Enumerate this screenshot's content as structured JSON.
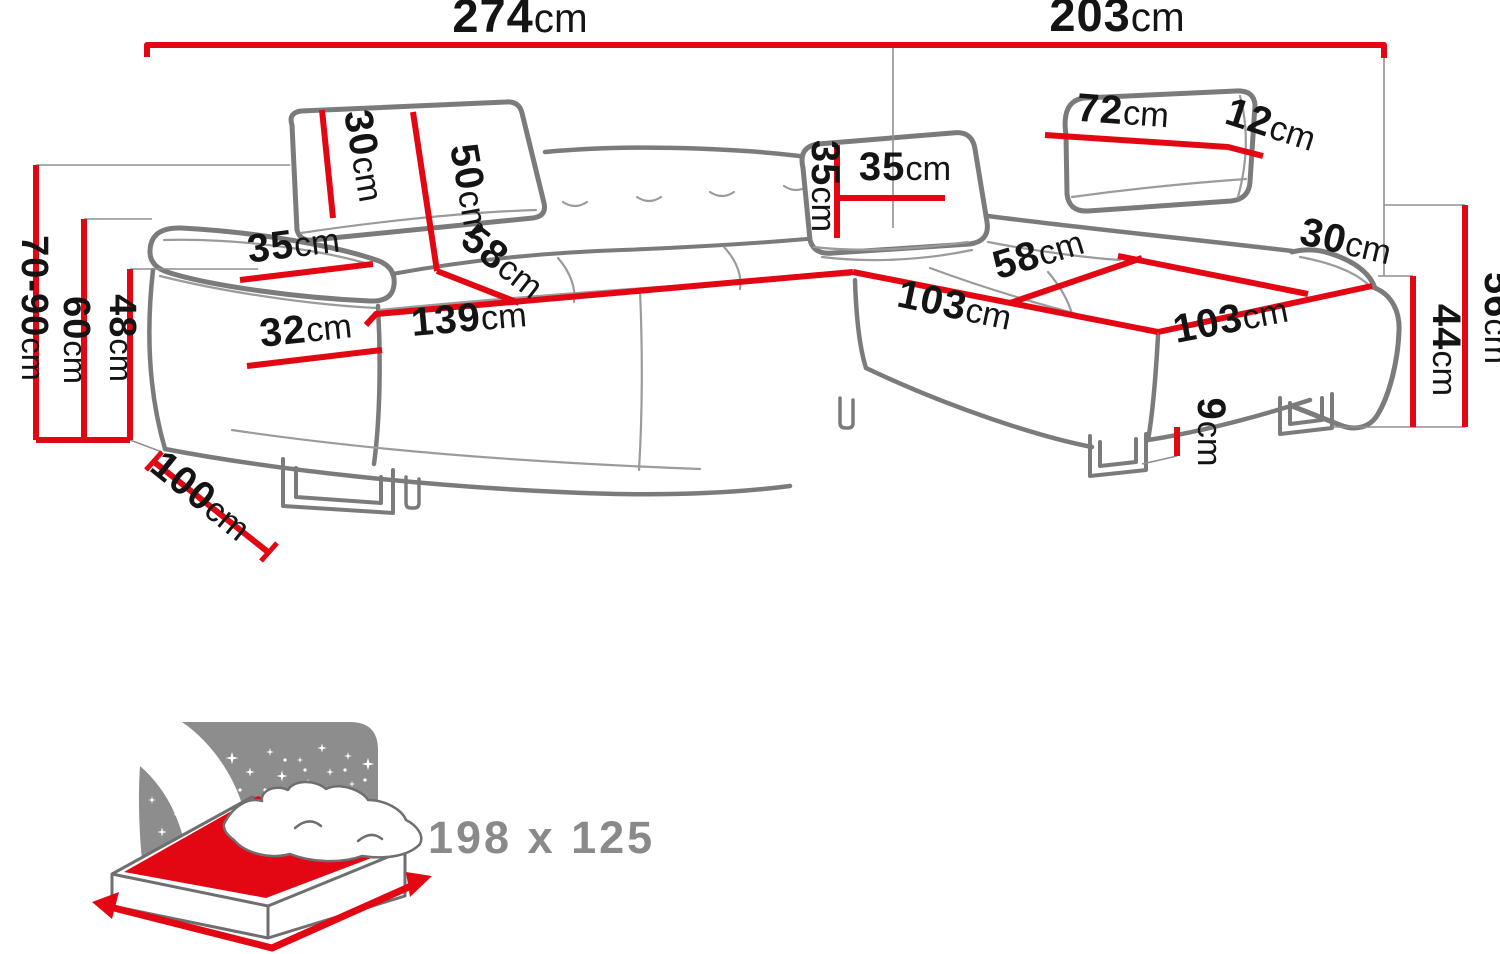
{
  "dims": {
    "width_left": {
      "num": "274",
      "unit": "cm"
    },
    "width_right": {
      "num": "203",
      "unit": "cm"
    },
    "height_total": {
      "num": "70-90",
      "unit": "cm"
    },
    "height_armrest": {
      "num": "60",
      "unit": "cm"
    },
    "height_seat": {
      "num": "48",
      "unit": "cm"
    },
    "headrest_left_h": {
      "num": "30",
      "unit": "cm"
    },
    "backrest_h": {
      "num": "50",
      "unit": "cm"
    },
    "seat_depth_left": {
      "num": "58",
      "unit": "cm"
    },
    "armrest_top_w": {
      "num": "35",
      "unit": "cm"
    },
    "armrest_front_w": {
      "num": "32",
      "unit": "cm"
    },
    "seat_width_left": {
      "num": "139",
      "unit": "cm"
    },
    "depth_left": {
      "num": "100",
      "unit": "cm"
    },
    "pillow_h": {
      "num": "35",
      "unit": "cm"
    },
    "pillow_w": {
      "num": "35",
      "unit": "cm"
    },
    "headrest_right_w": {
      "num": "72",
      "unit": "cm"
    },
    "headrest_gap": {
      "num": "12",
      "unit": "cm"
    },
    "armrest_right_w": {
      "num": "30",
      "unit": "cm"
    },
    "seat_depth_right": {
      "num": "58",
      "unit": "cm"
    },
    "chaise_len_left": {
      "num": "103",
      "unit": "cm"
    },
    "chaise_len_right": {
      "num": "103",
      "unit": "cm"
    },
    "chaise_seat_h": {
      "num": "44",
      "unit": "cm"
    },
    "chaise_total_h": {
      "num": "56",
      "unit": "cm"
    },
    "foot_h": {
      "num": "9",
      "unit": "cm"
    }
  },
  "sleeping_area": {
    "label": "198 x 125"
  },
  "colors": {
    "dim-red": "#e30613",
    "sofa-gray": "#7b7b7b",
    "bed-gray": "#8d8d8d",
    "bed-text": "#8a8a8a",
    "text-black": "#141414"
  }
}
